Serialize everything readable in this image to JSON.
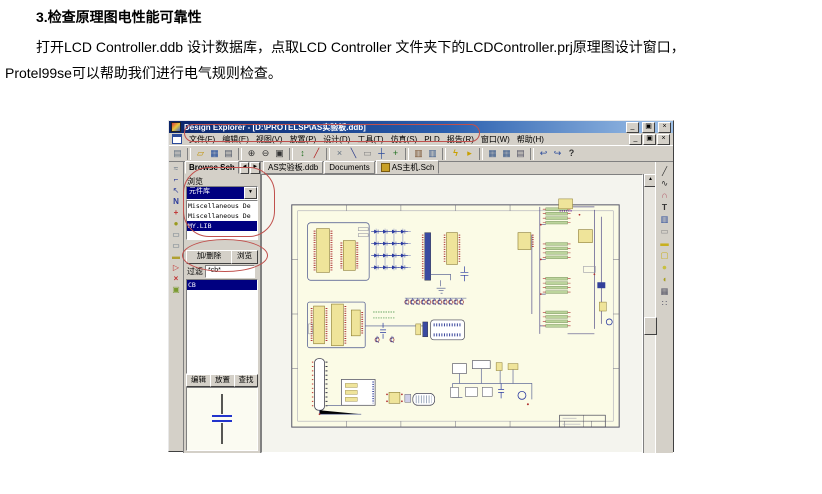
{
  "colors": {
    "titlebar_blue": "#0a246a",
    "selection_navy": "#000080",
    "annotation_red": "#c0504d",
    "sheet_cream": "#fbfbe6",
    "chrome_grey": "#d4d0c8"
  },
  "document": {
    "heading": "3.检查原理图电性能可靠性",
    "para_line1": "打开LCD Controller.ddb 设计数据库，点取LCD Controller 文件夹下的LCDController.prj原理图设计窗口，",
    "para_line2": "Protel99se可以帮助我们进行电气规则检查。"
  },
  "app": {
    "title": "Design Explorer - [D:\\PROTELSP\\AS实验板.ddb]",
    "window_buttons": {
      "minimize": "_",
      "restore": "▣",
      "close": "×"
    },
    "menus": [
      "文件(F)",
      "编辑(E)",
      "视图(V)",
      "放置(P)",
      "设计(D)",
      "工具(T)",
      "仿真(S)",
      "PLD",
      "报告(R)",
      "窗口(W)",
      "帮助(H)"
    ],
    "toolbar_icons": [
      {
        "name": "explorer-toggle-icon",
        "glyph": "▤"
      },
      {
        "name": "open-document-icon",
        "glyph": "▱"
      },
      {
        "name": "save-icon",
        "glyph": "▦"
      },
      {
        "name": "print-icon",
        "glyph": "▤"
      },
      {
        "name": "zoom-in-icon",
        "glyph": "⊕"
      },
      {
        "name": "zoom-out-icon",
        "glyph": "⊖"
      },
      {
        "name": "zoom-document-icon",
        "glyph": "▣"
      },
      {
        "name": "up-down-hierarchy-icon",
        "glyph": "↕"
      },
      {
        "name": "pencil-icon",
        "glyph": "╱"
      },
      {
        "name": "cutter-icon",
        "glyph": "×"
      },
      {
        "name": "wire-icon",
        "glyph": "╲"
      },
      {
        "name": "selection-box-icon",
        "glyph": "▭"
      },
      {
        "name": "deselect-icon",
        "glyph": "┼"
      },
      {
        "name": "move-icon",
        "glyph": "+"
      },
      {
        "name": "library-icon",
        "glyph": "▥"
      },
      {
        "name": "browse-library-icon",
        "glyph": "▥"
      },
      {
        "name": "erc-lightning-icon",
        "glyph": "ϟ"
      },
      {
        "name": "probe-icon",
        "glyph": "▸"
      },
      {
        "name": "hierarchy-up-icon",
        "glyph": "▦"
      },
      {
        "name": "hierarchy-down-icon",
        "glyph": "▦"
      },
      {
        "name": "clipboard-icon",
        "glyph": "▤"
      },
      {
        "name": "undo-icon",
        "glyph": "↩"
      },
      {
        "name": "redo-icon",
        "glyph": "↪"
      },
      {
        "name": "help-icon",
        "glyph": "?"
      }
    ],
    "left_strip_icons": [
      {
        "name": "pan-tool-icon",
        "glyph": "≈"
      },
      {
        "name": "wiring-tools-icon",
        "glyph": "⌐"
      },
      {
        "name": "cursor-tool-icon",
        "glyph": "↖"
      },
      {
        "name": "net-label-icon",
        "glyph": "N"
      },
      {
        "name": "power-port-icon",
        "glyph": "+"
      },
      {
        "name": "junction-icon",
        "glyph": "●"
      },
      {
        "name": "part-icon",
        "glyph": "▭"
      },
      {
        "name": "sheet-symbol-icon",
        "glyph": "▭"
      },
      {
        "name": "sheet-entry-icon",
        "glyph": "▬"
      },
      {
        "name": "port-icon",
        "glyph": "▷"
      },
      {
        "name": "no-erc-icon",
        "glyph": "×"
      },
      {
        "name": "pcb-directive-icon",
        "glyph": "▣"
      }
    ],
    "right_strip_icons": [
      {
        "name": "line-tool-icon",
        "glyph": "╱"
      },
      {
        "name": "bezier-tool-icon",
        "glyph": "∿"
      },
      {
        "name": "arc-tool-icon",
        "glyph": "∩"
      },
      {
        "name": "text-tool-icon",
        "glyph": "T"
      },
      {
        "name": "paste-array-icon",
        "glyph": "▥"
      },
      {
        "name": "rectangle-tool-icon",
        "glyph": "▭"
      },
      {
        "name": "filled-rectangle-tool-icon",
        "glyph": "▬"
      },
      {
        "name": "round-rectangle-tool-icon",
        "glyph": "▢"
      },
      {
        "name": "ellipse-tool-icon",
        "glyph": "●"
      },
      {
        "name": "pie-tool-icon",
        "glyph": "◖"
      },
      {
        "name": "graph-tool-icon",
        "glyph": "▦"
      },
      {
        "name": "grid-tool-icon",
        "glyph": "∷"
      }
    ],
    "browse_tab_label": "Browse Sch",
    "tab_arrows": {
      "left": "◄",
      "right": "►"
    },
    "doc_tabs": [
      "AS实验板.ddb",
      "Documents",
      "AS主机.Sch"
    ],
    "panel": {
      "browse_label": "浏览",
      "dropdown_value": "元件库",
      "dropdown_arrow": "▼",
      "libraries": [
        "Miscellaneous De",
        "Miscellaneous De",
        "MY.LIB"
      ],
      "add_remove_button": "加/删除",
      "browse_button": "浏览",
      "filter_label": "过滤",
      "filter_value": "*cb*",
      "components": [
        "CB"
      ],
      "edit_button": "编辑",
      "place_button": "放置",
      "find_button": "查找"
    },
    "scrollbar": {
      "up_arrow": "▲"
    }
  }
}
